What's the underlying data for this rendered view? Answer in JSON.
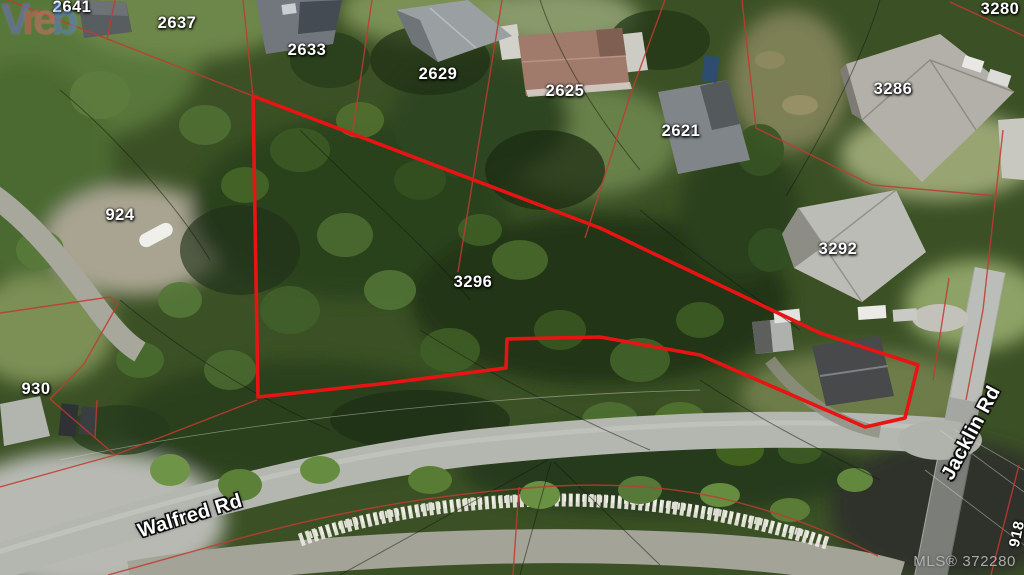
{
  "map": {
    "watermark_letters": [
      {
        "char": "V",
        "color": "#6f6fd8"
      },
      {
        "char": "r",
        "color": "#e05d5d"
      },
      {
        "char": "e",
        "color": "#e06e6e"
      },
      {
        "char": "b",
        "color": "#5b82d8"
      }
    ],
    "mls_label": "MLS® 372280",
    "parcel_labels": [
      {
        "text": "2641",
        "x": 72,
        "y": 7
      },
      {
        "text": "2637",
        "x": 177,
        "y": 23
      },
      {
        "text": "2633",
        "x": 307,
        "y": 50
      },
      {
        "text": "2629",
        "x": 438,
        "y": 74
      },
      {
        "text": "2625",
        "x": 565,
        "y": 91
      },
      {
        "text": "2621",
        "x": 681,
        "y": 131
      },
      {
        "text": "3280",
        "x": 1000,
        "y": 9
      },
      {
        "text": "3286",
        "x": 893,
        "y": 89
      },
      {
        "text": "3292",
        "x": 838,
        "y": 249
      },
      {
        "text": "3296",
        "x": 473,
        "y": 282
      },
      {
        "text": "924",
        "x": 120,
        "y": 215
      },
      {
        "text": "930",
        "x": 36,
        "y": 389
      },
      {
        "text": "918",
        "x": 1017,
        "y": 534,
        "rot": -78,
        "size": 15
      }
    ],
    "road_labels": [
      {
        "text": "Walfred Rd",
        "x": 190,
        "y": 516,
        "rot": -17
      },
      {
        "text": "Jacklin Rd",
        "x": 971,
        "y": 433,
        "rot": -62
      }
    ],
    "colors": {
      "subject_boundary": "#e81414",
      "cadastral_line": "#c23a30",
      "label_text": "#ffffff",
      "mls_text": "#b4b4b4"
    }
  }
}
